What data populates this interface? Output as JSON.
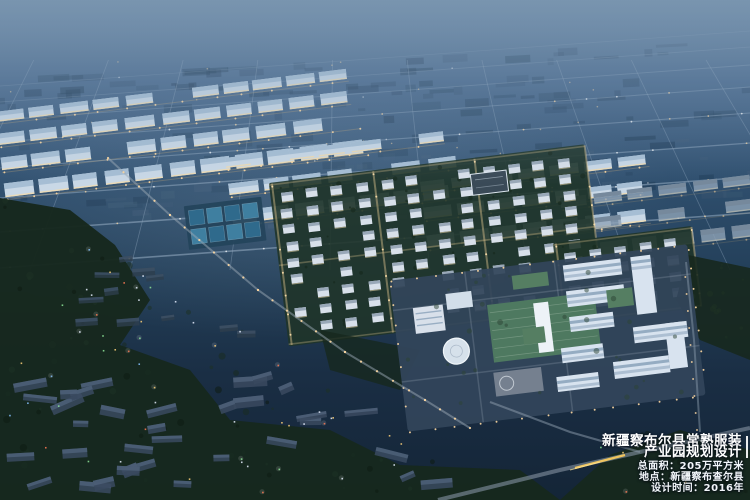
{
  "caption": {
    "title_lines": [
      "新疆察布尔县常熟服装",
      "产业园规划设计"
    ],
    "stats_lines": [
      "总面积：205万平方米",
      "地点：新疆察布查尔县",
      "设计时间：2016年"
    ]
  },
  "palette": {
    "sky_top": "#64829e",
    "sky_upper": "#46668a",
    "sky_mid": "#2f4f6e",
    "sky_low": "#233f59",
    "sky_deep": "#1a2e44",
    "sky_bottom": "#142537",
    "haze": "#8aa4bd",
    "plain_block": "#1b3650",
    "plain_block_light": "#46607a",
    "road_line": "#8ca3ba",
    "warm_light": "#ffd9a2",
    "warm_deep": "#e8b96d",
    "warehouse": "#c9d8e6",
    "warehouse_roof": "#a6bed4",
    "warehouse_dim": "#8ea3b6",
    "warehouse_dim_roof": "#76899c",
    "lit_base": "#f2dcae",
    "res_green": "#1f3429",
    "building_white": "#d8e0ea",
    "building_roof": "#99a8b8",
    "water": "#3f7fa0",
    "water_alt": "#2f6a8c",
    "pond_base": "#24455c",
    "campus_ground": "#32455a",
    "green_roof": "#4e7960",
    "green_roof2": "#557e62",
    "skylight": "#edf2f7",
    "office": "#d8e3ef",
    "window_band": "#8aa2ba",
    "plaza": "#9098a3",
    "forest": "#17281e",
    "forest_dark": "#0f1b13",
    "forest_mid": "#1e3224",
    "village": "#39495e",
    "village_top": "#50637a",
    "village_far": "#2e3e4e",
    "highway": "#7d8a9a",
    "streak": "#ffcf5e",
    "text": "#ffffff"
  }
}
